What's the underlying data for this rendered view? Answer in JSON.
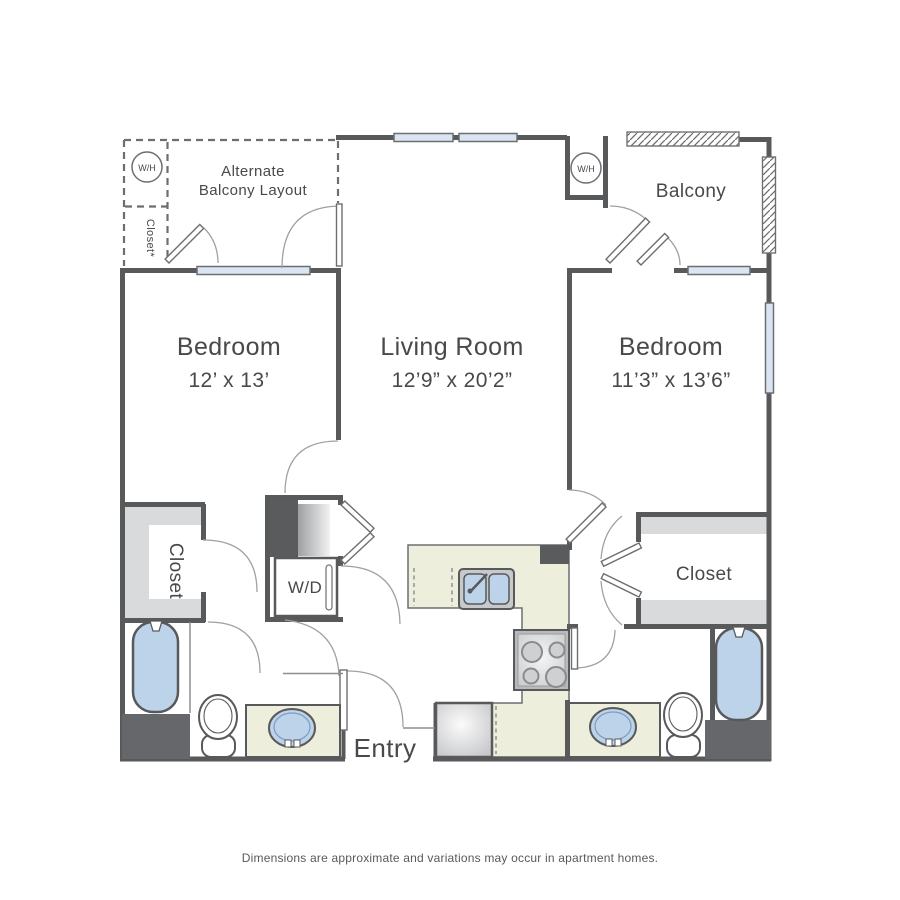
{
  "floorplan": {
    "disclaimer": "Dimensions are approximate and variations may occur in apartment homes.",
    "labels": {
      "bedroom_left": {
        "name": "Bedroom",
        "dims": "12’ x 13’"
      },
      "living_room": {
        "name": "Living Room",
        "dims": "12’9” x 20’2”"
      },
      "bedroom_right": {
        "name": "Bedroom",
        "dims": "11’3” x 13’6”"
      },
      "balcony": "Balcony",
      "alt_balcony_line1": "Alternate",
      "alt_balcony_line2": "Balcony Layout",
      "alt_closet": "Closet*",
      "water_heater_alt": "W/H",
      "water_heater": "W/H",
      "washer_dryer": "W/D",
      "closet_left": "Closet",
      "closet_right": "Closet",
      "entry": "Entry"
    },
    "colors": {
      "wall": "#58595b",
      "window_fill": "#dbe5f1",
      "counter": "#eeeedd",
      "fixture_blue": "#bdd3e9",
      "shelf_gray": "#d9dadb",
      "text": "#48494b"
    }
  }
}
